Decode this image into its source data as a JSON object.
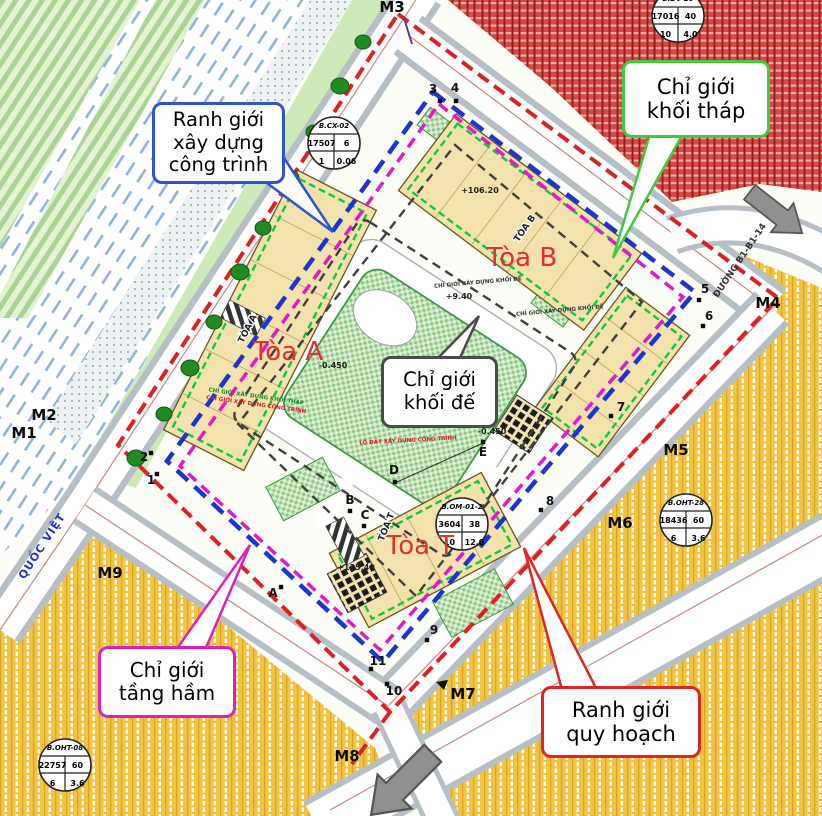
{
  "callouts": {
    "construction": {
      "line1": "Ranh giới",
      "line2": "xây dựng",
      "line3": "công trình"
    },
    "tower": {
      "line1": "Chỉ giới",
      "line2": "khối tháp"
    },
    "podium": {
      "line1": "Chỉ giới",
      "line2": "khối đế"
    },
    "basement": {
      "line1": "Chỉ giới",
      "line2": "tầng hầm"
    },
    "planning": {
      "line1": "Ranh giới",
      "line2": "quy hoạch"
    }
  },
  "buildings": {
    "toa_a": "Tòa A",
    "toa_b": "Tòa B",
    "toa_t": "Tòa T",
    "toa_a_plan": "TÒA A",
    "toa_b_plan": "TÒA B",
    "toa_t_plan": "TÒA T"
  },
  "parcels": {
    "cx02": {
      "name": "B.CX-02",
      "v1": "17507",
      "v2": "6",
      "v3": "1",
      "v4": "0.06"
    },
    "dv20": {
      "name": "B.DV-20",
      "v1": "17016",
      "v2": "40",
      "v3": "10",
      "v4": "4.0"
    },
    "oht28": {
      "name": "B.OHT-28",
      "v1": "18436",
      "v2": "60",
      "v3": "6",
      "v4": "3.6"
    },
    "oht08": {
      "name": "B.OHT-08",
      "v1": "22757",
      "v2": "60",
      "v3": "6",
      "v4": "3.6"
    },
    "om012": {
      "name": "B.OM-01-2",
      "v1": "3604",
      "v2": "38",
      "v3": "10",
      "v4": "12.0"
    }
  },
  "markers": {
    "m1": "M1",
    "m2": "M2",
    "m3": "M3",
    "m4": "M4",
    "m5": "M5",
    "m6": "M6",
    "m7": "M7",
    "m8": "M8",
    "m9": "M9",
    "p1": "1",
    "p2": "2",
    "p3": "3",
    "p4": "4",
    "p5": "5",
    "p6": "6",
    "p7": "7",
    "p8": "8",
    "p9": "9",
    "p10": "10",
    "p11": "11",
    "pa": "A",
    "pb": "B",
    "pc": "C",
    "pd": "D",
    "pe": "E"
  },
  "elevations": {
    "toa_b_top": "+106.20",
    "podium": "+9.40",
    "court_w": "-0.450",
    "court_e": "-0.450",
    "toa_t_top": "+115.40"
  },
  "roads": {
    "west": "QUỐC VIỆT",
    "east": "ĐƯỜNG B1-B1-14"
  },
  "notes": {
    "tower_edge": "CHỈ GIỚI XÂY DỰNG KHỐI THÁP",
    "construction_edge": "CHỈ GIỚI XÂY DỰNG CÔNG TRÌNH",
    "podium_edge": "CHỈ GIỚI XÂY DỰNG KHỐI ĐẾ",
    "lot": "LÔ ĐẤT XÂY DỰNG CÔNG TRÌNH"
  },
  "colors": {
    "planning_red": "#e02020",
    "construction_blue": "#1a35d0",
    "basement_magenta": "#e318c8",
    "tower_green": "#0fc93c",
    "podium_gray": "#3f3f3f"
  }
}
